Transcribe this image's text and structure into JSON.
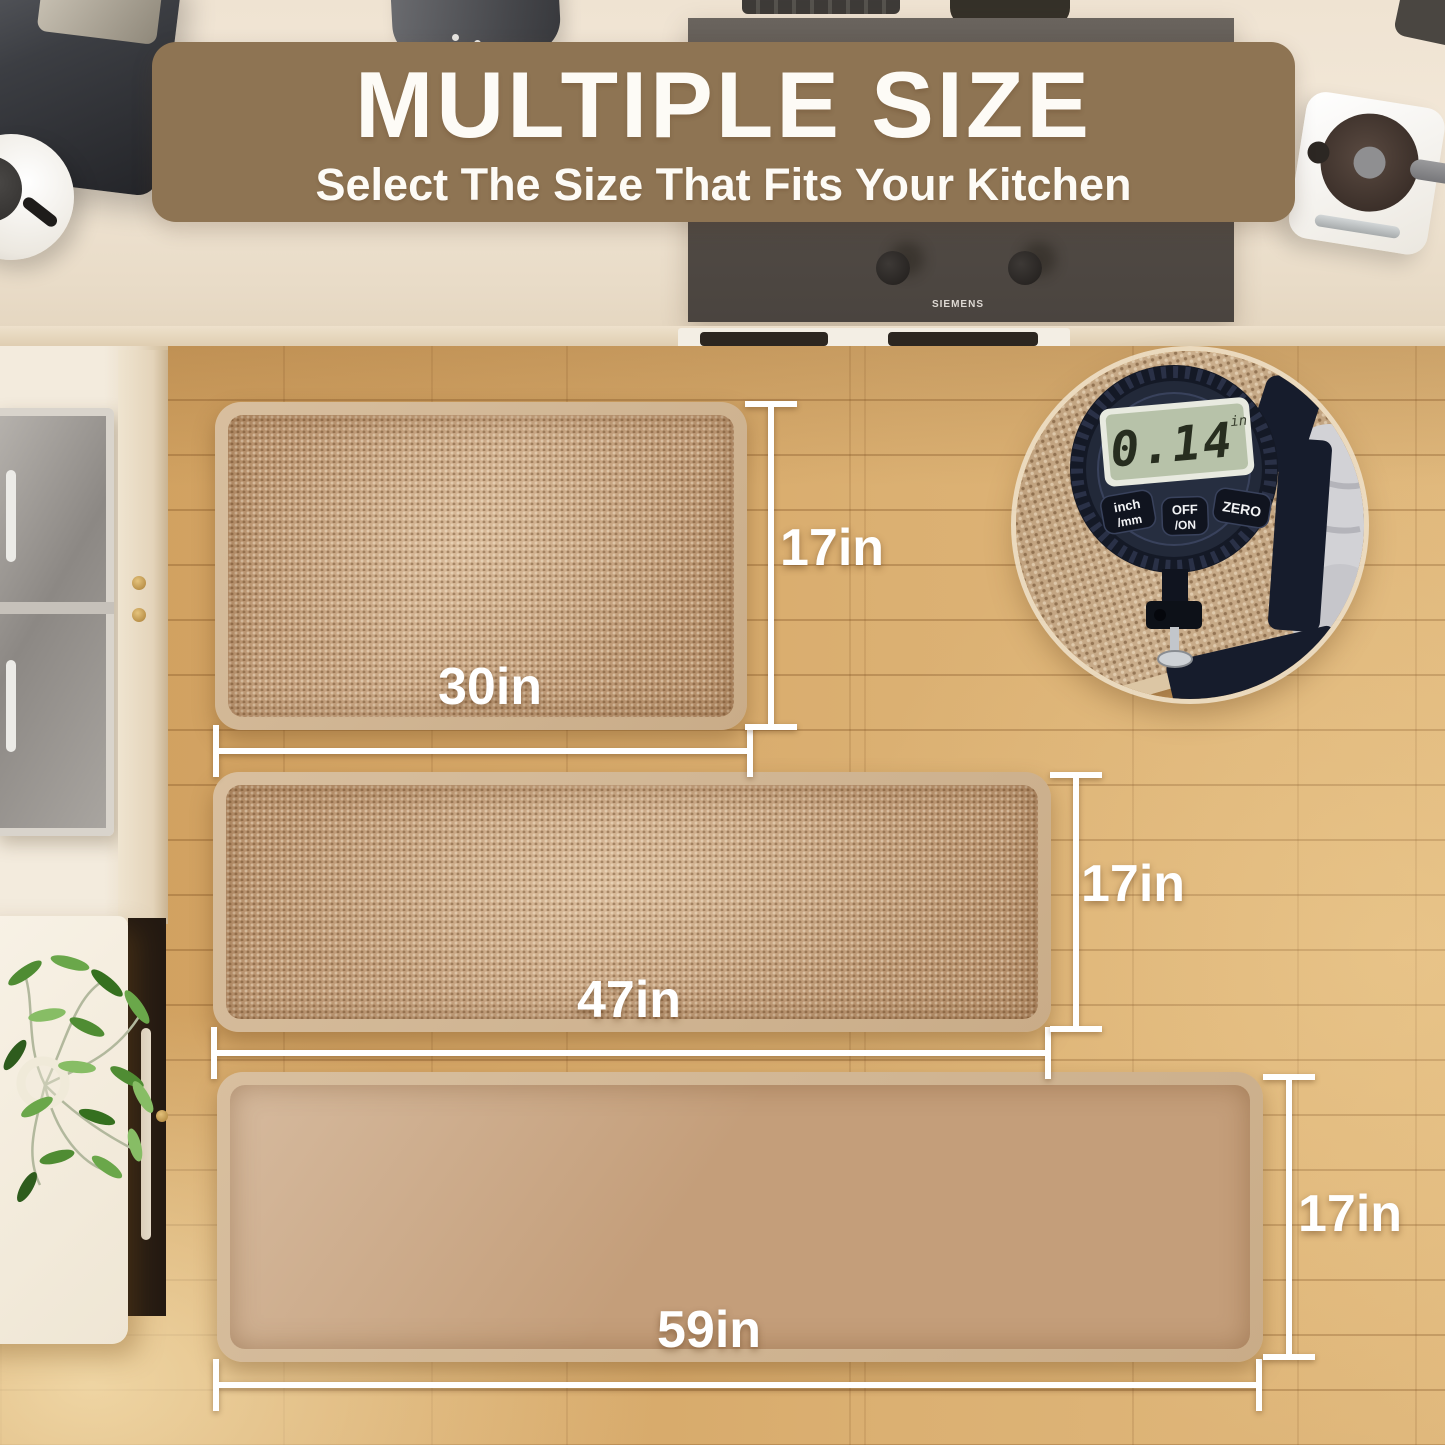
{
  "banner": {
    "title": "MULTIPLE SIZE",
    "subtitle": "Select The Size That Fits Your Kitchen",
    "bg_color": "#8e7453",
    "text_color": "#fdfbf6"
  },
  "mats": [
    {
      "id": "mat-30",
      "width_label": "30in",
      "height_label": "17in"
    },
    {
      "id": "mat-47",
      "width_label": "47in",
      "height_label": "17in"
    },
    {
      "id": "mat-59",
      "width_label": "59in",
      "height_label": "17in"
    }
  ],
  "stove": {
    "brand": "SIEMENS"
  },
  "gauge": {
    "reading": "0.14",
    "unit": "in",
    "btn1_top": "inch",
    "btn1_bottom": "/mm",
    "btn2_top": "OFF",
    "btn2_bottom": "/ON",
    "btn3": "ZERO"
  },
  "colors": {
    "banner_bg": "#8e7453",
    "dimension_lines": "#ffffff",
    "mat_border": "#cdb391",
    "mat_surface": "#c09a76",
    "floor_wood": "#d5a666",
    "gauge_body": "#222939",
    "gauge_lcd": "#b7c2a9"
  }
}
